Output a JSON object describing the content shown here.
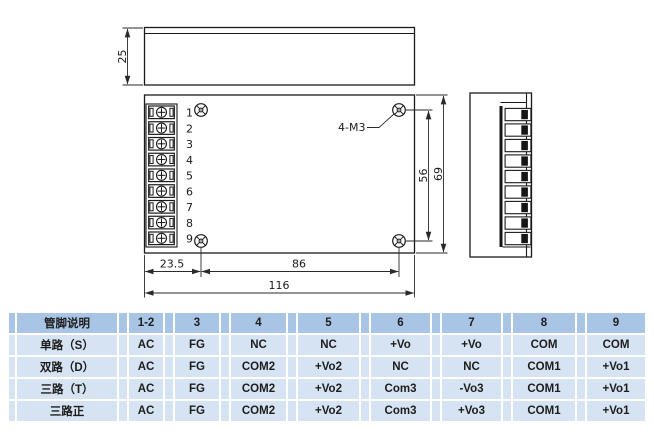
{
  "drawing": {
    "top_view": {
      "height_dim": "25"
    },
    "front_view": {
      "pins": [
        "1",
        "2",
        "3",
        "4",
        "5",
        "6",
        "7",
        "8",
        "9"
      ],
      "screw_label": "4-M3",
      "dims": {
        "left_to_hole": "23.5",
        "hole_span_h": "86",
        "total_width": "116",
        "hole_span_v": "56",
        "total_height": "69"
      }
    },
    "colors": {
      "line": "#1a1a1a"
    }
  },
  "table": {
    "colors": {
      "header_bg": "#a9c5e5",
      "row_bg": "#d6e3f2",
      "text": "#1d1d1d"
    },
    "header": {
      "label": "管脚说明",
      "cols": [
        "1-2",
        "3",
        "4",
        "5",
        "6",
        "7",
        "8",
        "9"
      ]
    },
    "rows": [
      {
        "label": "单路（S）",
        "cells": [
          "AC",
          "FG",
          "NC",
          "NC",
          "+Vo",
          "+Vo",
          "COM",
          "COM"
        ]
      },
      {
        "label": "双路（D）",
        "cells": [
          "AC",
          "FG",
          "COM2",
          "+Vo2",
          "NC",
          "NC",
          "COM1",
          "+Vo1"
        ]
      },
      {
        "label": "三路（T）",
        "cells": [
          "AC",
          "FG",
          "COM2",
          "+Vo2",
          "Com3",
          "-Vo3",
          "COM1",
          "+Vo1"
        ]
      },
      {
        "label": "三路正",
        "cells": [
          "AC",
          "FG",
          "COM2",
          "+Vo2",
          "Com3",
          "+Vo3",
          "COM1",
          "+Vo1"
        ]
      }
    ]
  }
}
